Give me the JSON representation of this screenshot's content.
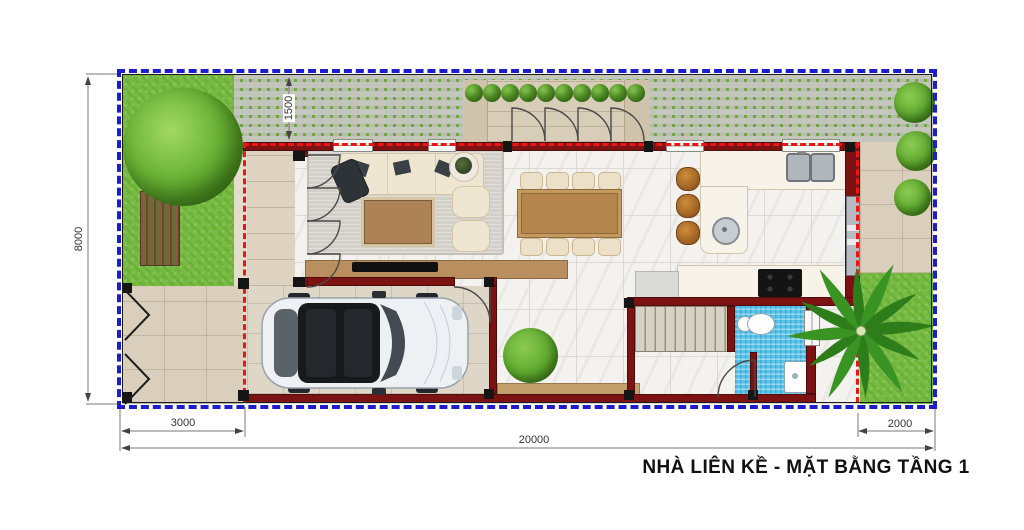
{
  "title": "NHÀ LIÊN KỀ - MẶT BẰNG TẦNG 1",
  "dimensions": {
    "plot_depth": "8000",
    "front_yard_width": "3000",
    "total_length": "20000",
    "back_yard_width": "2000",
    "walkway_depth": "1500"
  },
  "colors": {
    "boundary-blue": "#1d1dd0",
    "setback-red": "#ee1414",
    "wall-maroon": "#7c1312",
    "grass-green": "#77bb41",
    "paver-green": "#6fa83c",
    "paver-gray": "#c3c6bb",
    "marble": "#f4f2ee",
    "stone": "#d9cfbc",
    "bath-blue": "#59c4e8",
    "wood-brown": "#b5854e",
    "rug-gray": "#d3d0ca",
    "counter-cream": "#f7f3e9"
  }
}
